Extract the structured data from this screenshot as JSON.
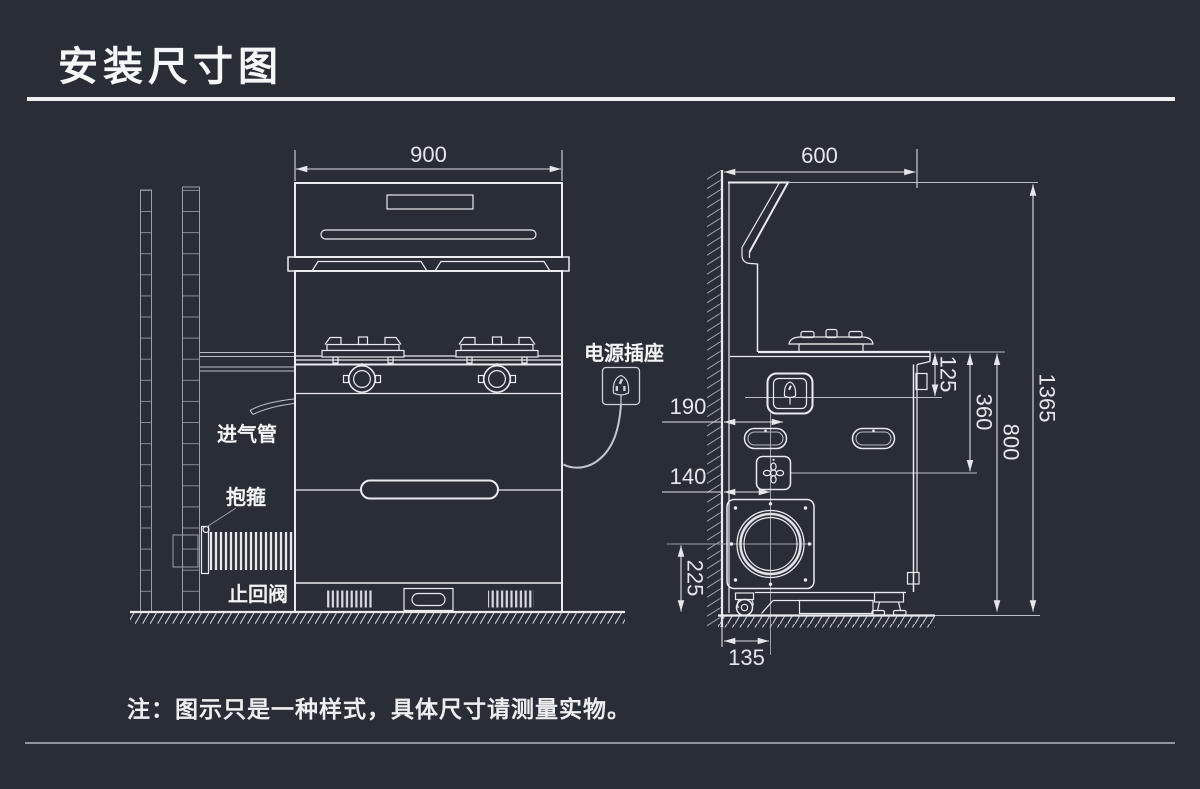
{
  "title": "安装尺寸图",
  "note": "注：图示只是一种样式，具体尺寸请测量实物。",
  "front_view": {
    "width_dim": "900",
    "labels": {
      "power_socket": "电源插座",
      "gas_inlet": "进气管",
      "clamp": "抱箍",
      "check_valve": "止回阀"
    }
  },
  "side_view": {
    "depth_dim": "600",
    "socket_from_wall": "190",
    "valve_from_wall": "140",
    "counter_to_seam": "125",
    "counter_to_valve": "360",
    "counter_height": "800",
    "overall_height": "1365",
    "outlet_center_height": "225",
    "outlet_from_wall": "135"
  },
  "colors": {
    "background": "#292d36",
    "line": "#e9ebee",
    "faint_line": "#9aa0a8",
    "text": "#f3f4f6"
  }
}
